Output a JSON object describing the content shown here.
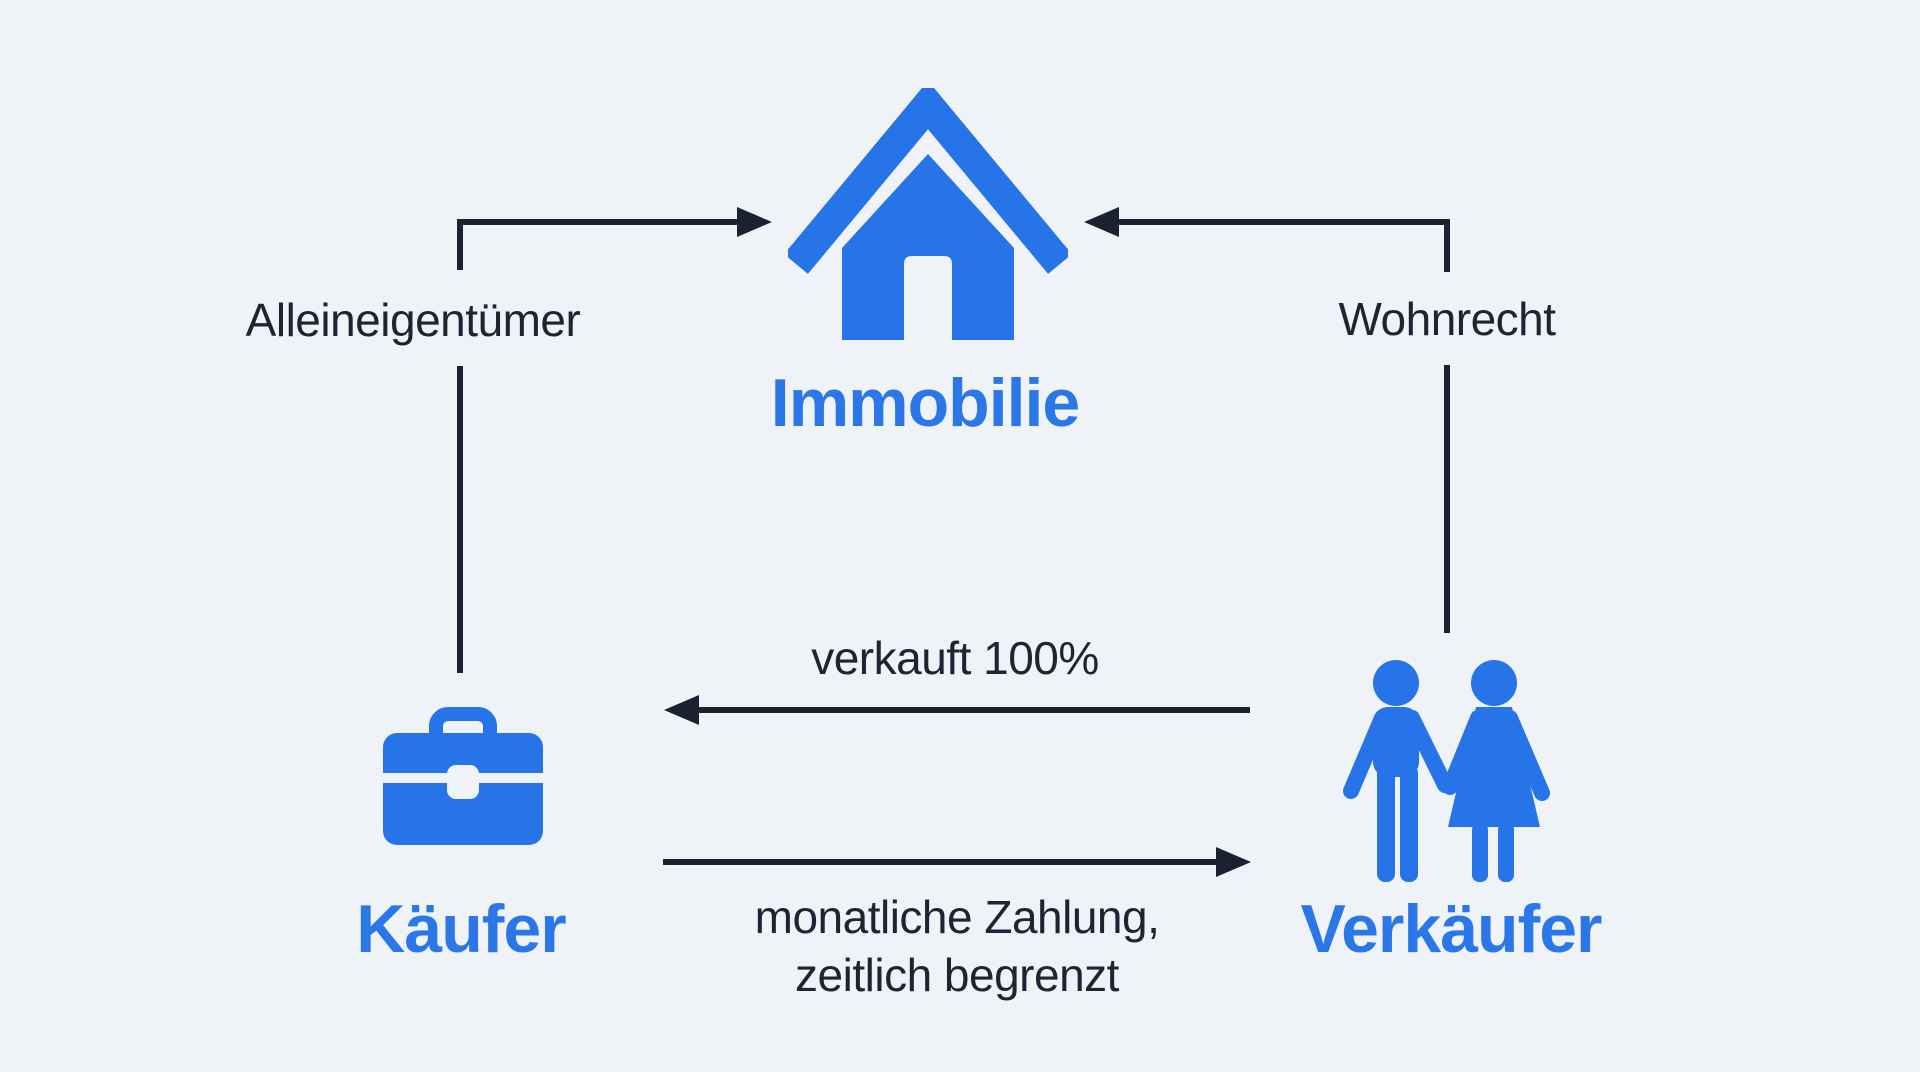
{
  "diagram": {
    "background_color": "#eff2f7",
    "accent_color": "#2674e8",
    "accent_text_color": "#2b77e8",
    "line_color": "#1a2231",
    "nodes": {
      "immobilie": {
        "label": "Immobilie",
        "icon": "house-icon"
      },
      "kaeufer": {
        "label": "Käufer",
        "icon": "briefcase-icon"
      },
      "verkaeufer": {
        "label": "Verkäufer",
        "icon": "couple-icon"
      }
    },
    "edges": {
      "kaeufer_to_immobilie": {
        "label": "Alleineigentümer",
        "direction": "kaeufer → immobilie"
      },
      "verkaeufer_to_immobilie": {
        "label": "Wohnrecht",
        "direction": "verkaeufer → immobilie"
      },
      "verkaeufer_to_kaeufer": {
        "label": "verkauft 100%",
        "direction": "verkaeufer → kaeufer"
      },
      "kaeufer_to_verkaeufer": {
        "label_line1": "monatliche Zahlung,",
        "label_line2": "zeitlich begrenzt",
        "direction": "kaeufer → verkaeufer"
      }
    }
  }
}
